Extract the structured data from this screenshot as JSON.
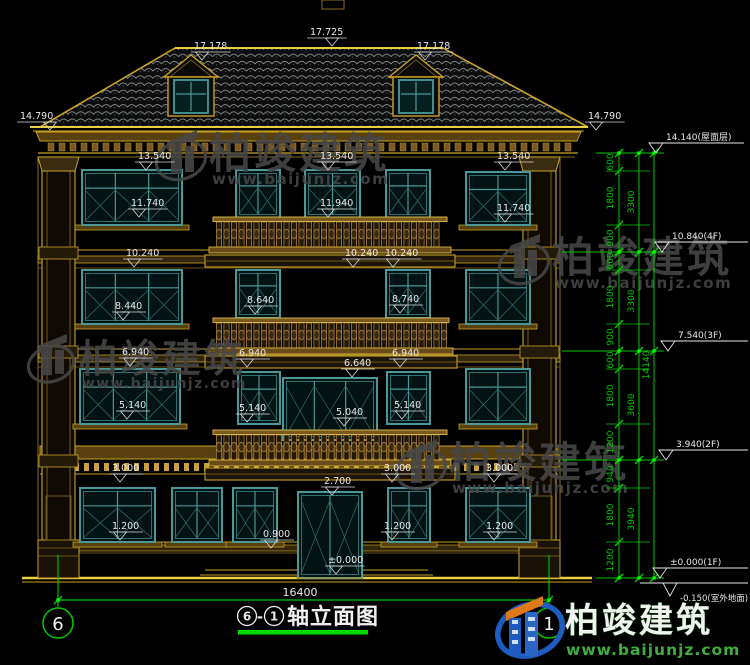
{
  "sheet": {
    "title": {
      "axis_from": "6",
      "axis_to": "1",
      "text": "轴立面图",
      "full": "⑥-①轴立面图"
    },
    "bottom_dimension": "16400",
    "axes": {
      "left": {
        "label": "6",
        "x": 58
      },
      "right": {
        "label": "1",
        "x": 549
      }
    }
  },
  "labels": [
    {
      "t": "17.725",
      "x": 310,
      "y": 26,
      "ta": 22
    },
    {
      "t": "17.178",
      "x": 194,
      "y": 40
    },
    {
      "t": "17.178",
      "x": 417,
      "y": 40
    },
    {
      "t": "14.790",
      "x": 20,
      "y": 110,
      "ta": 30
    },
    {
      "t": "14.790",
      "x": 588,
      "y": 110
    },
    {
      "t": "13.540",
      "x": 138,
      "y": 150
    },
    {
      "t": "13.540",
      "x": 320,
      "y": 150
    },
    {
      "t": "13.540",
      "x": 497,
      "y": 150
    },
    {
      "t": "11.740",
      "x": 131,
      "y": 197
    },
    {
      "t": "11.940",
      "x": 320,
      "y": 197
    },
    {
      "t": "11.740",
      "x": 497,
      "y": 202
    },
    {
      "t": "10.240",
      "x": 126,
      "y": 247
    },
    {
      "t": "10.240",
      "x": 345,
      "y": 247
    },
    {
      "t": "10.240",
      "x": 385,
      "y": 247
    },
    {
      "t": "8.440",
      "x": 115,
      "y": 300
    },
    {
      "t": "8.640",
      "x": 247,
      "y": 294
    },
    {
      "t": "8.740",
      "x": 392,
      "y": 293
    },
    {
      "t": "6.940",
      "x": 122,
      "y": 346
    },
    {
      "t": "6.940",
      "x": 239,
      "y": 347
    },
    {
      "t": "6.940",
      "x": 392,
      "y": 347
    },
    {
      "t": "6.640",
      "x": 344,
      "y": 357
    },
    {
      "t": "5.140",
      "x": 119,
      "y": 399
    },
    {
      "t": "5.140",
      "x": 239,
      "y": 402
    },
    {
      "t": "5.040",
      "x": 336,
      "y": 406
    },
    {
      "t": "5.140",
      "x": 394,
      "y": 399
    },
    {
      "t": "3.000",
      "x": 112,
      "y": 462
    },
    {
      "t": "3.000",
      "x": 384,
      "y": 462
    },
    {
      "t": "3.000",
      "x": 486,
      "y": 462
    },
    {
      "t": "2.700",
      "x": 324,
      "y": 475
    },
    {
      "t": "1.200",
      "x": 112,
      "y": 520
    },
    {
      "t": "1.200",
      "x": 384,
      "y": 520
    },
    {
      "t": "1.200",
      "x": 486,
      "y": 520
    },
    {
      "t": "0.900",
      "x": 263,
      "y": 528
    },
    {
      "t": "±0.000",
      "x": 328,
      "y": 554
    }
  ],
  "right_chain": {
    "boundaries": [
      153,
      171,
      225,
      252,
      270,
      324,
      351,
      369,
      424,
      460,
      488,
      542,
      578
    ],
    "floor_boundaries": [
      153,
      252,
      351,
      460,
      578
    ],
    "segments": [
      {
        "t": "600",
        "y": 162
      },
      {
        "t": "1800",
        "y": 198
      },
      {
        "t": "900",
        "y": 238
      },
      {
        "t": "600",
        "y": 261
      },
      {
        "t": "1800",
        "y": 297
      },
      {
        "t": "900",
        "y": 337
      },
      {
        "t": "600",
        "y": 360
      },
      {
        "t": "1800",
        "y": 396
      },
      {
        "t": "1200",
        "y": 442
      },
      {
        "t": "940",
        "y": 474
      },
      {
        "t": "1800",
        "y": 515
      },
      {
        "t": "1200",
        "y": 560
      }
    ],
    "floors": [
      {
        "t": "3300",
        "y": 202
      },
      {
        "t": "3300",
        "y": 301
      },
      {
        "t": "3600",
        "y": 405
      },
      {
        "t": "3940",
        "y": 519
      }
    ],
    "total": {
      "t": "14140",
      "y": 365
    },
    "elevations": [
      {
        "t": "14.140(屋面层)",
        "y": 153,
        "ax": 656
      },
      {
        "t": "10.840(4F)",
        "y": 252,
        "ax": 662
      },
      {
        "t": "7.540(3F)",
        "y": 351,
        "ax": 668
      },
      {
        "t": "3.940(2F)",
        "y": 460,
        "ax": 666
      },
      {
        "t": "±0.000(1F)",
        "y": 578,
        "ax": 660
      },
      {
        "t": "-0.150(室外地面)",
        "y": 583,
        "ax": 670,
        "flip": true
      }
    ]
  },
  "brand": {
    "name": "柏竣建筑",
    "site": "www.baijunjz.com"
  },
  "watermarks": [
    {
      "x": 157,
      "y": 128,
      "s": 1.0
    },
    {
      "x": 500,
      "y": 232,
      "s": 1.0
    },
    {
      "x": 27,
      "y": 332,
      "s": 0.92
    },
    {
      "x": 397,
      "y": 437,
      "s": 1.0
    }
  ],
  "colors": {
    "gold": "#c9a227",
    "gold_bright": "#e8d040",
    "gold_dim": "#8a6e1e",
    "brown": "#58400f",
    "fill_dark": "#241a08",
    "teal": "#4a9898",
    "teal_dim": "#2f7070",
    "white": "#e8e8e8",
    "green": "#00c800",
    "wm_gray": "#474747",
    "logo_blue": "#1f5cc0",
    "logo_blue2": "#2b66c4",
    "logo_orange": "#e07818",
    "logo_green": "#3fae3f",
    "roof_grid": "#8f9898",
    "baluster": "#a77b3a"
  }
}
